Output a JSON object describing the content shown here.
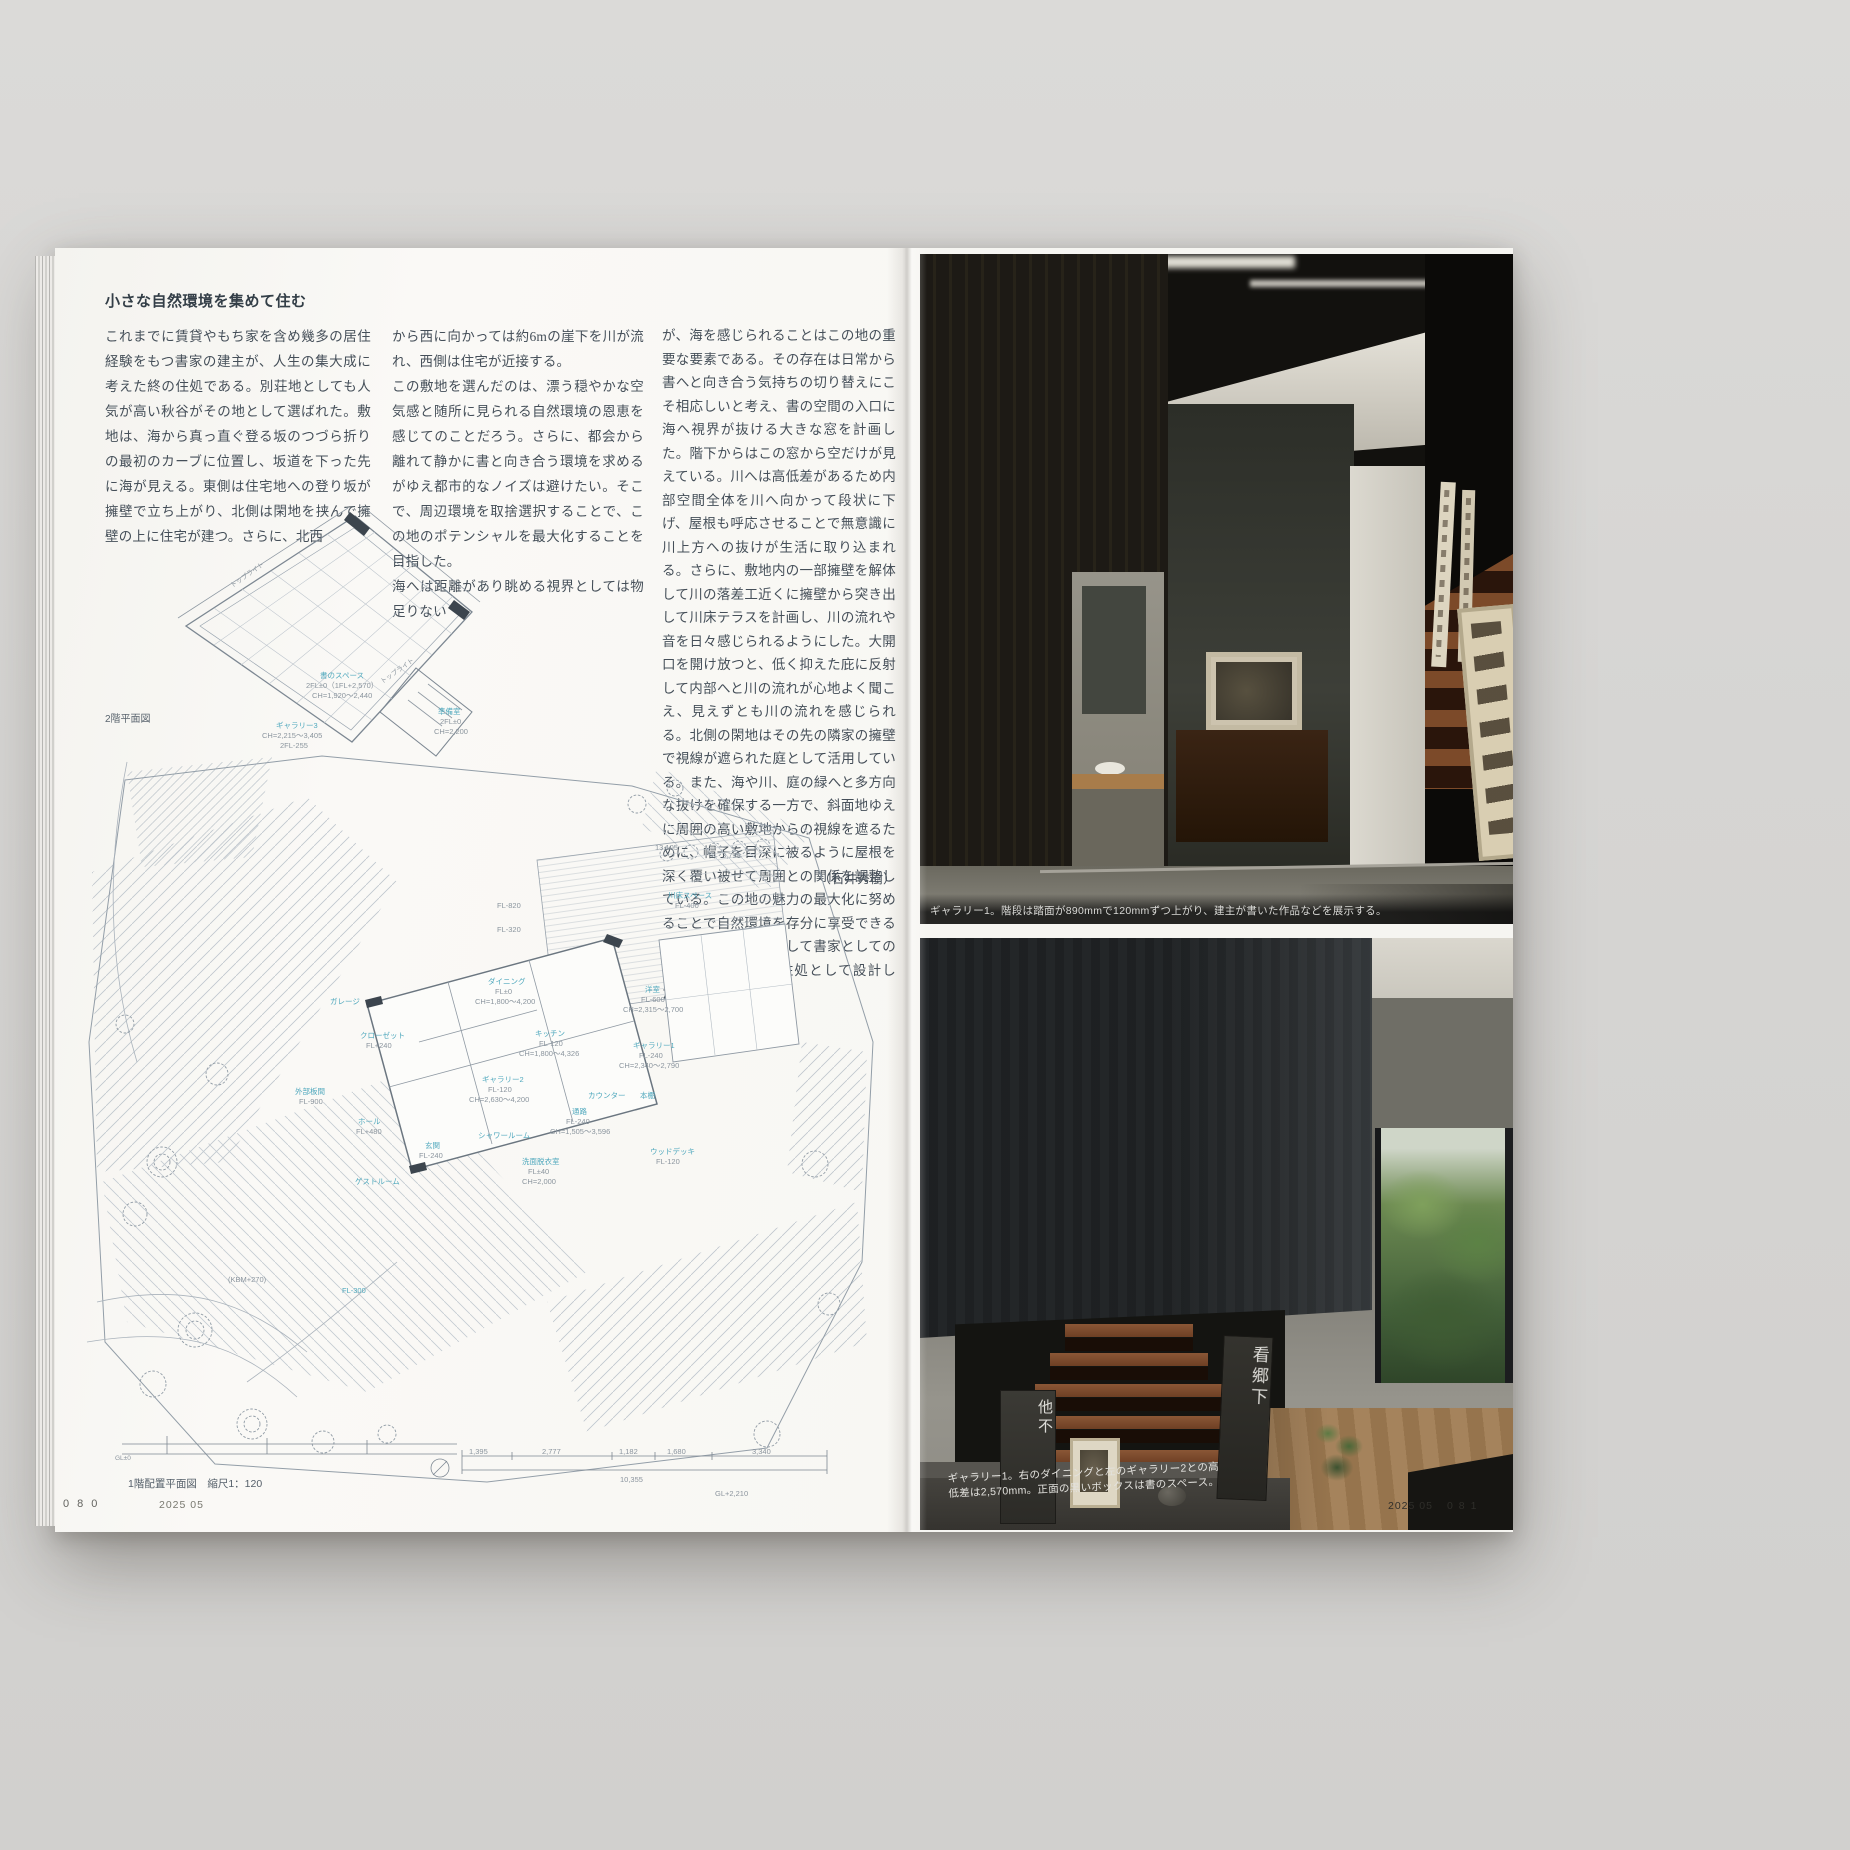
{
  "colors": {
    "backdrop": "#d7d6d3",
    "paper": "#f7f6f3",
    "ink": "#454f59",
    "plan_line": "#9aa5b0",
    "plan_accent": "#4fa8bd"
  },
  "magazine": {
    "left_page": {
      "heading": "小さな自然環境を集めて住む",
      "col1": "これまでに賃貸やもち家を含め幾多の居住経験をもつ書家の建主が、人生の集大成に考えた終の住処である。別荘地としても人気が高い秋谷がその地として選ばれた。敷地は、海から真っ直ぐ登る坂のつづら折りの最初のカーブに位置し、坂道を下った先に海が見える。東側は住宅地への登り坂が擁壁で立ち上がり、北側は閑地を挟んで擁壁の上に住宅が建つ。さらに、北西",
      "col2": "から西に向かっては約6mの崖下を川が流れ、西側は住宅が近接する。\nこの敷地を選んだのは、漂う穏やかな空気感と随所に見られる自然環境の恩恵を感じてのことだろう。さらに、都会から離れて静かに書と向き合う環境を求めるがゆえ都市的なノイズは避けたい。そこで、周辺環境を取捨選択することで、この地のポテンシャルを最大化することを目指した。\n海へは距離があり眺める視界としては物足りない",
      "col3": "が、海を感じられることはこの地の重要な要素である。その存在は日常から書へと向き合う気持ちの切り替えにこそ相応しいと考え、書の空間の入口に海へ視界が抜ける大きな窓を計画した。階下からはこの窓から空だけが見えている。川へは高低差があるため内部空間全体を川へ向かって段状に下げ、屋根も呼応させることで無意識に川上方への抜けが生活に取り込まれる。さらに、敷地内の一部擁壁を解体して川の落差工近くに擁壁から突き出して川床テラスを計画し、川の流れや音を日々感じられるようにした。大開口を開け放つと、低く抑えた庇に反射して内部へと川の流れが心地よく聞こえ、見えずとも川の流れを感じられる。北側の閑地はその先の隣家の擁壁で視線が遮られた庭として活用している。また、海や川、庭の緑へと多方向な抜けを確保する一方で、斜面地ゆえに周囲の高い敷地からの視線を遮るために、帽子を目深に被るように屋根を深く覆い被せて周囲との関係を調整している。この地の魅力の最大化に努めることで自然環境を存分に享受できる終の住処として、そして書家としての人生を彩る新たな住処として設計した。",
      "author": "（石井秀樹）",
      "plan2f_caption": "2階平面図",
      "plan1f_caption": "1階配置平面図　縮尺1：120",
      "footer_page": "080",
      "footer_issue": "2025 05",
      "plan2f_labels": [
        {
          "t": "書のスペース",
          "x": 150,
          "y": 168,
          "c": "#4fa8bd"
        },
        {
          "t": "2FL±0（1FL+2,570）",
          "x": 136,
          "y": 178
        },
        {
          "t": "CH=1,920〜2,440",
          "x": 142,
          "y": 188
        },
        {
          "t": "準備室",
          "x": 268,
          "y": 204,
          "c": "#4fa8bd"
        },
        {
          "t": "2FL±0",
          "x": 270,
          "y": 214
        },
        {
          "t": "CH=2,200",
          "x": 264,
          "y": 224
        },
        {
          "t": "ギャラリー3",
          "x": 106,
          "y": 218,
          "c": "#4fa8bd"
        },
        {
          "t": "CH=2,215〜3,405",
          "x": 92,
          "y": 228
        },
        {
          "t": "2FL-255",
          "x": 110,
          "y": 238
        },
        {
          "t": "トップライト",
          "x": 62,
          "y": 80,
          "r": -35,
          "fs": 6.5
        },
        {
          "t": "トップライト",
          "x": 212,
          "y": 176,
          "r": -35,
          "fs": 6.5
        }
      ],
      "plan1f_labels": [
        {
          "t": "13,105",
          "x": 588,
          "y": 102
        },
        {
          "t": "3,798",
          "x": 655,
          "y": 110
        },
        {
          "t": "川床スペース",
          "x": 601,
          "y": 150,
          "c": "#4fa8bd"
        },
        {
          "t": "FL-400",
          "x": 608,
          "y": 160
        },
        {
          "t": "FL-820",
          "x": 430,
          "y": 160
        },
        {
          "t": "FL-320",
          "x": 430,
          "y": 184
        },
        {
          "t": "ダイニング",
          "x": 421,
          "y": 236,
          "c": "#4fa8bd"
        },
        {
          "t": "FL±0",
          "x": 428,
          "y": 246
        },
        {
          "t": "CH=1,800〜4,200",
          "x": 408,
          "y": 256
        },
        {
          "t": "キッチン",
          "x": 468,
          "y": 288,
          "c": "#4fa8bd"
        },
        {
          "t": "FL-120",
          "x": 472,
          "y": 298
        },
        {
          "t": "CH=1,800〜4,326",
          "x": 452,
          "y": 308
        },
        {
          "t": "洋室",
          "x": 578,
          "y": 244,
          "c": "#4fa8bd"
        },
        {
          "t": "FL-600",
          "x": 574,
          "y": 254
        },
        {
          "t": "CH=2,315〜2,700",
          "x": 556,
          "y": 264
        },
        {
          "t": "ギャラリー1",
          "x": 566,
          "y": 300,
          "c": "#4fa8bd"
        },
        {
          "t": "FL-240",
          "x": 572,
          "y": 310
        },
        {
          "t": "CH=2,340〜2,790",
          "x": 552,
          "y": 320
        },
        {
          "t": "ギャラリー2",
          "x": 415,
          "y": 334,
          "c": "#4fa8bd"
        },
        {
          "t": "FL-120",
          "x": 421,
          "y": 344
        },
        {
          "t": "CH=2,630〜4,200",
          "x": 402,
          "y": 354
        },
        {
          "t": "ガレージ",
          "x": 263,
          "y": 256,
          "c": "#4fa8bd"
        },
        {
          "t": "クローゼット",
          "x": 293,
          "y": 290,
          "c": "#4fa8bd"
        },
        {
          "t": "FL+240",
          "x": 299,
          "y": 300
        },
        {
          "t": "外部板間",
          "x": 228,
          "y": 346,
          "c": "#4fa8bd"
        },
        {
          "t": "FL-900",
          "x": 232,
          "y": 356
        },
        {
          "t": "ホール",
          "x": 291,
          "y": 376,
          "c": "#4fa8bd"
        },
        {
          "t": "FL+480",
          "x": 289,
          "y": 386
        },
        {
          "t": "玄関",
          "x": 358,
          "y": 400,
          "c": "#4fa8bd"
        },
        {
          "t": "FL-240",
          "x": 352,
          "y": 410
        },
        {
          "t": "シャワールーム",
          "x": 411,
          "y": 390,
          "c": "#4fa8bd"
        },
        {
          "t": "洗面脱衣室",
          "x": 455,
          "y": 416,
          "c": "#4fa8bd"
        },
        {
          "t": "FL±40",
          "x": 461,
          "y": 426
        },
        {
          "t": "CH=2,000",
          "x": 455,
          "y": 436
        },
        {
          "t": "通路",
          "x": 505,
          "y": 366,
          "c": "#4fa8bd"
        },
        {
          "t": "FL-240",
          "x": 499,
          "y": 376
        },
        {
          "t": "CH=1,505〜3,596",
          "x": 483,
          "y": 386
        },
        {
          "t": "カウンター",
          "x": 521,
          "y": 350,
          "c": "#4fa8bd"
        },
        {
          "t": "本棚",
          "x": 573,
          "y": 350,
          "c": "#4fa8bd"
        },
        {
          "t": "ウッドデッキ",
          "x": 583,
          "y": 406,
          "c": "#4fa8bd"
        },
        {
          "t": "FL-120",
          "x": 589,
          "y": 416
        },
        {
          "t": "ゲストルーム",
          "x": 288,
          "y": 436,
          "c": "#4fa8bd"
        },
        {
          "t": "(KBM+270)",
          "x": 161,
          "y": 534
        },
        {
          "t": "FL-300",
          "x": 275,
          "y": 545,
          "c": "#4fa8bd"
        },
        {
          "t": "GL±0",
          "x": 48,
          "y": 714,
          "fs": 6.5
        },
        {
          "t": "1,395",
          "x": 402,
          "y": 706
        },
        {
          "t": "2,777",
          "x": 475,
          "y": 706
        },
        {
          "t": "1,182",
          "x": 552,
          "y": 706
        },
        {
          "t": "1,680",
          "x": 600,
          "y": 706
        },
        {
          "t": "3,340",
          "x": 685,
          "y": 706
        },
        {
          "t": "10,355",
          "x": 553,
          "y": 734
        },
        {
          "t": "GL+2,210",
          "x": 648,
          "y": 748
        }
      ]
    },
    "right_page": {
      "photo1_caption": "ギャラリー1。階段は踏面が890mmで120mmずつ上がり、建主が書いた作品などを展示する。",
      "photo2_caption_l1": "ギャラリー1。右のダイニングと左のギャラリー2との高",
      "photo2_caption_l2": "低差は2,570mm。正面の黒いボックスは書のスペース。",
      "scroll_left": "他不",
      "scroll_right": "看郷下",
      "footer_issue": "2025 05",
      "footer_page": "081"
    }
  }
}
